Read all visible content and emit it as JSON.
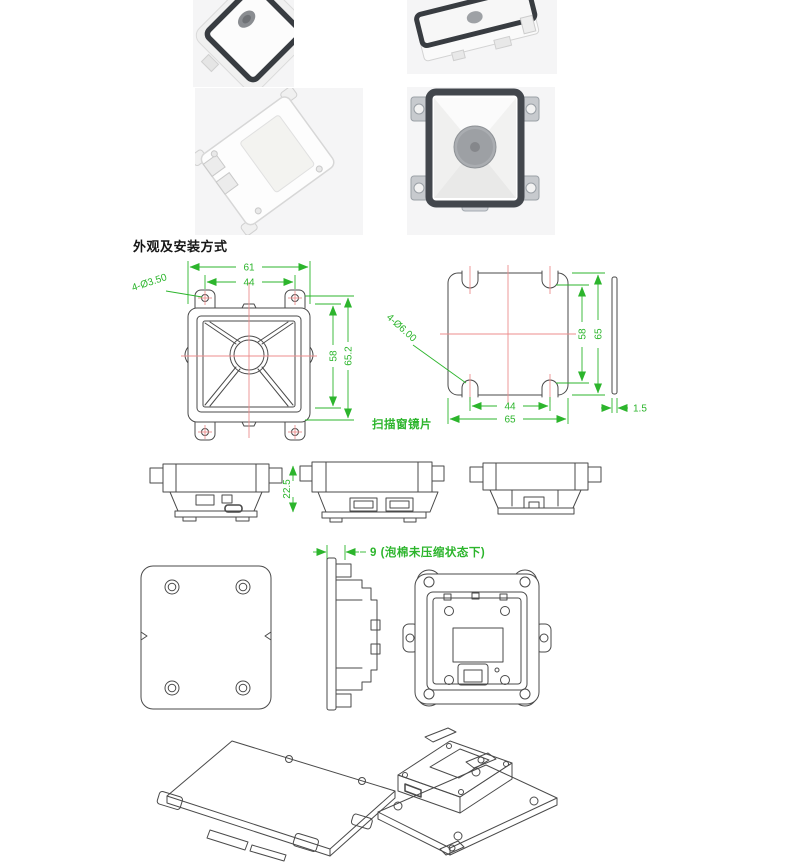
{
  "page": {
    "title": "外观及安装方式"
  },
  "colors": {
    "dimension_green": "#2cb52c",
    "centerline_red": "#ec8d8d",
    "drawing_line": "#4a4a4a",
    "photo_background": "#f5f5f6",
    "bezel_dark": "#3c4046"
  },
  "front_view": {
    "overall_width": "61",
    "hole_spacing_width": "44",
    "mount_hole_note": "4-Ø3.50",
    "body_height": "58",
    "overall_height": "65.2"
  },
  "scan_window": {
    "label": "扫描窗镜片",
    "hole_note": "4-Ø6.00",
    "inner_height": "58",
    "outer_height": "65",
    "inner_width": "44",
    "outer_width": "65",
    "thickness": "1.5"
  },
  "side_view": {
    "height": "22.5"
  },
  "rear_mount": {
    "foam_gap_note": "9 (泡棉未压缩状态下)"
  }
}
